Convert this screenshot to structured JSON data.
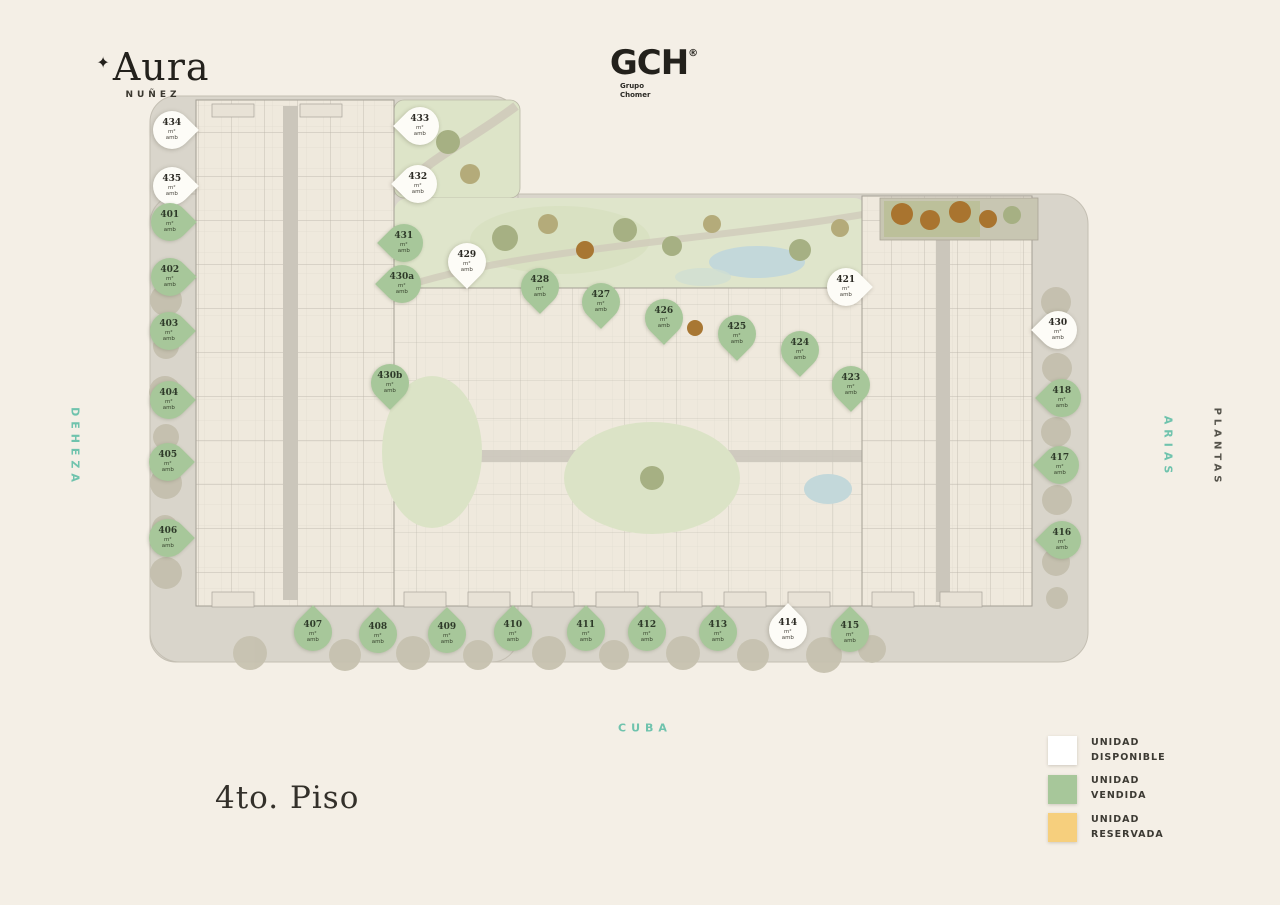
{
  "brand": {
    "star": "✦",
    "logo": "Aura",
    "sub": "NUÑEZ"
  },
  "developer": {
    "name": "GCH",
    "reg": "®",
    "line1": "Grupo",
    "line2": "Chomer"
  },
  "floor_label": "4to. Piso",
  "streets": {
    "left": "DEHEZA",
    "right": "ARIAS",
    "right_outer": "PLANTAS",
    "bottom": "CUBA"
  },
  "legend": {
    "items": [
      {
        "name": "available",
        "line1": "UNIDAD",
        "line2": "DISPONIBLE",
        "color": "#ffffff"
      },
      {
        "name": "sold",
        "line1": "UNIDAD",
        "line2": "VENDIDA",
        "color": "#a7c79a"
      },
      {
        "name": "reserved",
        "line1": "UNIDAD",
        "line2": "RESERVADA",
        "color": "#f6cf7d"
      }
    ]
  },
  "colors": {
    "background": "#f4efe6",
    "accent_teal": "#6fc3ad",
    "pin_available": "#fdfcf7",
    "pin_sold": "#a7c79a",
    "reserved_yellow": "#f6cf7d",
    "text_dark": "#2f2c26"
  },
  "plan": {
    "pins": [
      {
        "id": "434",
        "status": "available",
        "dir": "right",
        "x": 172,
        "y": 130,
        "sub1": "m²",
        "sub2": "amb"
      },
      {
        "id": "435",
        "status": "available",
        "dir": "right",
        "x": 172,
        "y": 186,
        "sub1": "m²",
        "sub2": "amb"
      },
      {
        "id": "401",
        "status": "sold",
        "dir": "right",
        "x": 170,
        "y": 222,
        "sub1": "m²",
        "sub2": "amb"
      },
      {
        "id": "402",
        "status": "sold",
        "dir": "right",
        "x": 170,
        "y": 277,
        "sub1": "m²",
        "sub2": "amb"
      },
      {
        "id": "403",
        "status": "sold",
        "dir": "right",
        "x": 169,
        "y": 331,
        "sub1": "m²",
        "sub2": "amb"
      },
      {
        "id": "404",
        "status": "sold",
        "dir": "right",
        "x": 169,
        "y": 400,
        "sub1": "m²",
        "sub2": "amb"
      },
      {
        "id": "405",
        "status": "sold",
        "dir": "right",
        "x": 168,
        "y": 462,
        "sub1": "m²",
        "sub2": "amb"
      },
      {
        "id": "406",
        "status": "sold",
        "dir": "right",
        "x": 168,
        "y": 538,
        "sub1": "m²",
        "sub2": "amb"
      },
      {
        "id": "433",
        "status": "available",
        "dir": "left",
        "x": 420,
        "y": 126,
        "sub1": "m²",
        "sub2": "amb"
      },
      {
        "id": "432",
        "status": "available",
        "dir": "left",
        "x": 418,
        "y": 184,
        "sub1": "m²",
        "sub2": "amb"
      },
      {
        "id": "431",
        "status": "sold",
        "dir": "left",
        "x": 404,
        "y": 243,
        "sub1": "m²",
        "sub2": "amb"
      },
      {
        "id": "430a",
        "status": "sold",
        "dir": "left",
        "x": 402,
        "y": 284,
        "sub1": "m²",
        "sub2": "amb"
      },
      {
        "id": "430b",
        "status": "sold",
        "dir": "down",
        "x": 390,
        "y": 383,
        "sub1": "m²",
        "sub2": "amb"
      },
      {
        "id": "429",
        "status": "available",
        "dir": "down",
        "x": 467,
        "y": 262,
        "sub1": "m²",
        "sub2": "amb"
      },
      {
        "id": "428",
        "status": "sold",
        "dir": "down",
        "x": 540,
        "y": 287,
        "sub1": "m²",
        "sub2": "amb"
      },
      {
        "id": "427",
        "status": "sold",
        "dir": "down",
        "x": 601,
        "y": 302,
        "sub1": "m²",
        "sub2": "amb"
      },
      {
        "id": "426",
        "status": "sold",
        "dir": "down",
        "x": 664,
        "y": 318,
        "sub1": "m²",
        "sub2": "amb"
      },
      {
        "id": "425",
        "status": "sold",
        "dir": "down",
        "x": 737,
        "y": 334,
        "sub1": "m²",
        "sub2": "amb"
      },
      {
        "id": "424",
        "status": "sold",
        "dir": "down",
        "x": 800,
        "y": 350,
        "sub1": "m²",
        "sub2": "amb"
      },
      {
        "id": "423",
        "status": "sold",
        "dir": "down",
        "x": 851,
        "y": 385,
        "sub1": "m²",
        "sub2": "amb"
      },
      {
        "id": "421",
        "status": "available",
        "dir": "right",
        "x": 846,
        "y": 287,
        "sub1": "m²",
        "sub2": "amb"
      },
      {
        "id": "430",
        "status": "available",
        "dir": "left",
        "x": 1058,
        "y": 330,
        "sub1": "m²",
        "sub2": "amb"
      },
      {
        "id": "418",
        "status": "sold",
        "dir": "left",
        "x": 1062,
        "y": 398,
        "sub1": "m²",
        "sub2": "amb"
      },
      {
        "id": "417",
        "status": "sold",
        "dir": "left",
        "x": 1060,
        "y": 465,
        "sub1": "m²",
        "sub2": "amb"
      },
      {
        "id": "416",
        "status": "sold",
        "dir": "left",
        "x": 1062,
        "y": 540,
        "sub1": "m²",
        "sub2": "amb"
      },
      {
        "id": "407",
        "status": "sold",
        "dir": "up",
        "x": 313,
        "y": 632,
        "sub1": "m²",
        "sub2": "amb"
      },
      {
        "id": "408",
        "status": "sold",
        "dir": "up",
        "x": 378,
        "y": 634,
        "sub1": "m²",
        "sub2": "amb"
      },
      {
        "id": "409",
        "status": "sold",
        "dir": "up",
        "x": 447,
        "y": 634,
        "sub1": "m²",
        "sub2": "amb"
      },
      {
        "id": "410",
        "status": "sold",
        "dir": "up",
        "x": 513,
        "y": 632,
        "sub1": "m²",
        "sub2": "amb"
      },
      {
        "id": "411",
        "status": "sold",
        "dir": "up",
        "x": 586,
        "y": 632,
        "sub1": "m²",
        "sub2": "amb"
      },
      {
        "id": "412",
        "status": "sold",
        "dir": "up",
        "x": 647,
        "y": 632,
        "sub1": "m²",
        "sub2": "amb"
      },
      {
        "id": "413",
        "status": "sold",
        "dir": "up",
        "x": 718,
        "y": 632,
        "sub1": "m²",
        "sub2": "amb"
      },
      {
        "id": "414",
        "status": "available",
        "dir": "up",
        "x": 788,
        "y": 630,
        "sub1": "m²",
        "sub2": "amb"
      },
      {
        "id": "415",
        "status": "sold",
        "dir": "up",
        "x": 850,
        "y": 633,
        "sub1": "m²",
        "sub2": "amb"
      }
    ]
  }
}
